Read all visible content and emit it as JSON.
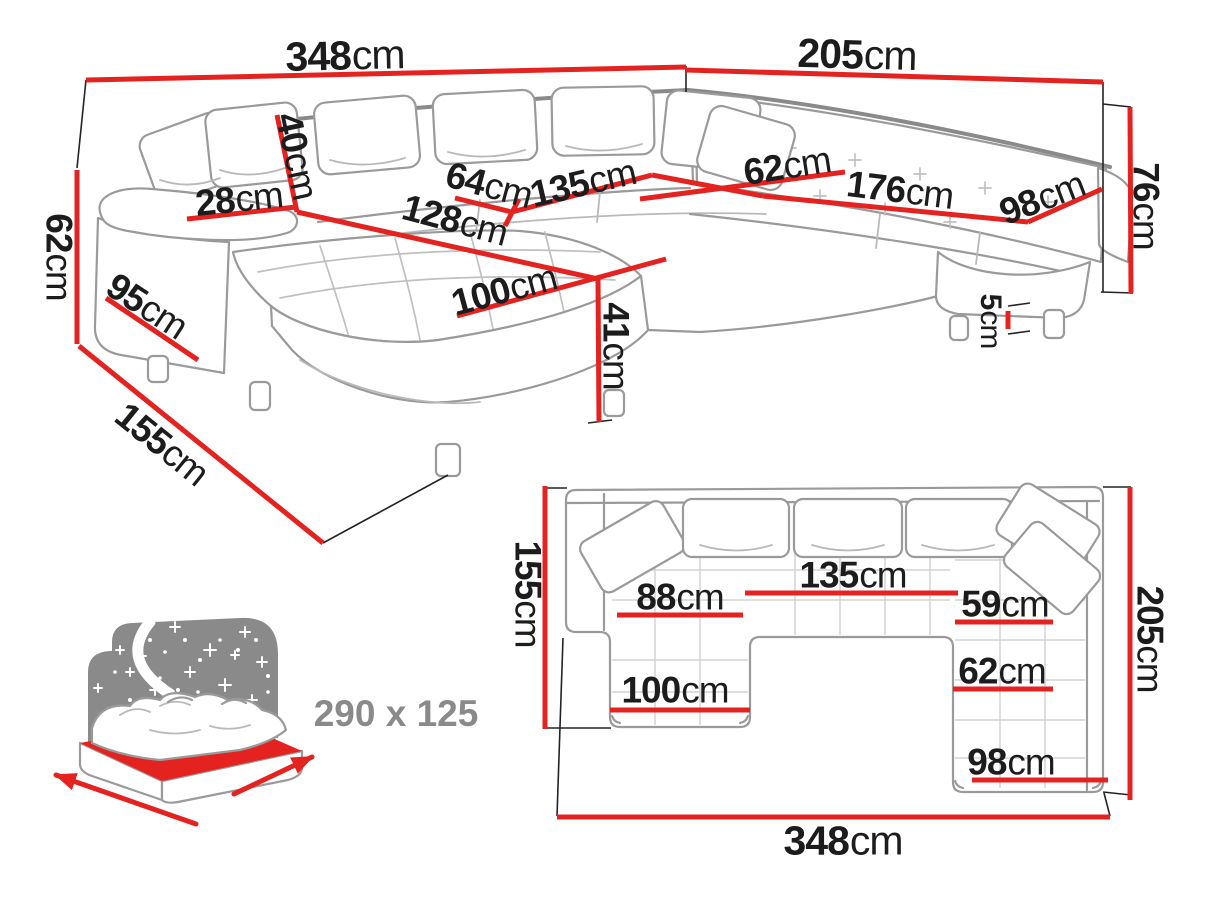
{
  "colors": {
    "dimension_red": "#e42320",
    "sketch_gray": "#9a9a9a",
    "icon_gray": "#8a8a8a",
    "label_color": "#1c1c1c"
  },
  "perspective_view": {
    "dims": {
      "total_width": {
        "v": "348",
        "u": "cm"
      },
      "right_width": {
        "v": "205",
        "u": "cm"
      },
      "arm_height": {
        "v": "62",
        "u": "cm"
      },
      "side_depth": {
        "v": "95",
        "u": "cm"
      },
      "chaise_total_depth": {
        "v": "155",
        "u": "cm"
      },
      "arm_top_depth": {
        "v": "28",
        "u": "cm"
      },
      "back_cushion_height": {
        "v": "40",
        "u": "cm"
      },
      "seat_depth": {
        "v": "64",
        "u": "cm"
      },
      "seat_width": {
        "v": "135",
        "u": "cm"
      },
      "chaise_length": {
        "v": "128",
        "u": "cm"
      },
      "chaise_width": {
        "v": "100",
        "u": "cm"
      },
      "seat_height": {
        "v": "41",
        "u": "cm"
      },
      "right_seat_depth": {
        "v": "62",
        "u": "cm"
      },
      "right_seat_width": {
        "v": "176",
        "u": "cm"
      },
      "end_seat_width": {
        "v": "98",
        "u": "cm"
      },
      "back_height": {
        "v": "76",
        "u": "cm"
      },
      "leg_height": {
        "v": "5",
        "u": "cm"
      }
    }
  },
  "plan_view": {
    "dims": {
      "left_depth": {
        "v": "155",
        "u": "cm"
      },
      "chaise_seat_width": {
        "v": "88",
        "u": "cm"
      },
      "middle_seat_width": {
        "v": "135",
        "u": "cm"
      },
      "right_top_seat_width": {
        "v": "59",
        "u": "cm"
      },
      "right_seat_depth": {
        "v": "62",
        "u": "cm"
      },
      "chaise_width": {
        "v": "100",
        "u": "cm"
      },
      "end_seat_width": {
        "v": "98",
        "u": "cm"
      },
      "right_depth": {
        "v": "205",
        "u": "cm"
      },
      "total_width": {
        "v": "348",
        "u": "cm"
      }
    }
  },
  "sleeping_function": {
    "label": "290 x 125"
  }
}
